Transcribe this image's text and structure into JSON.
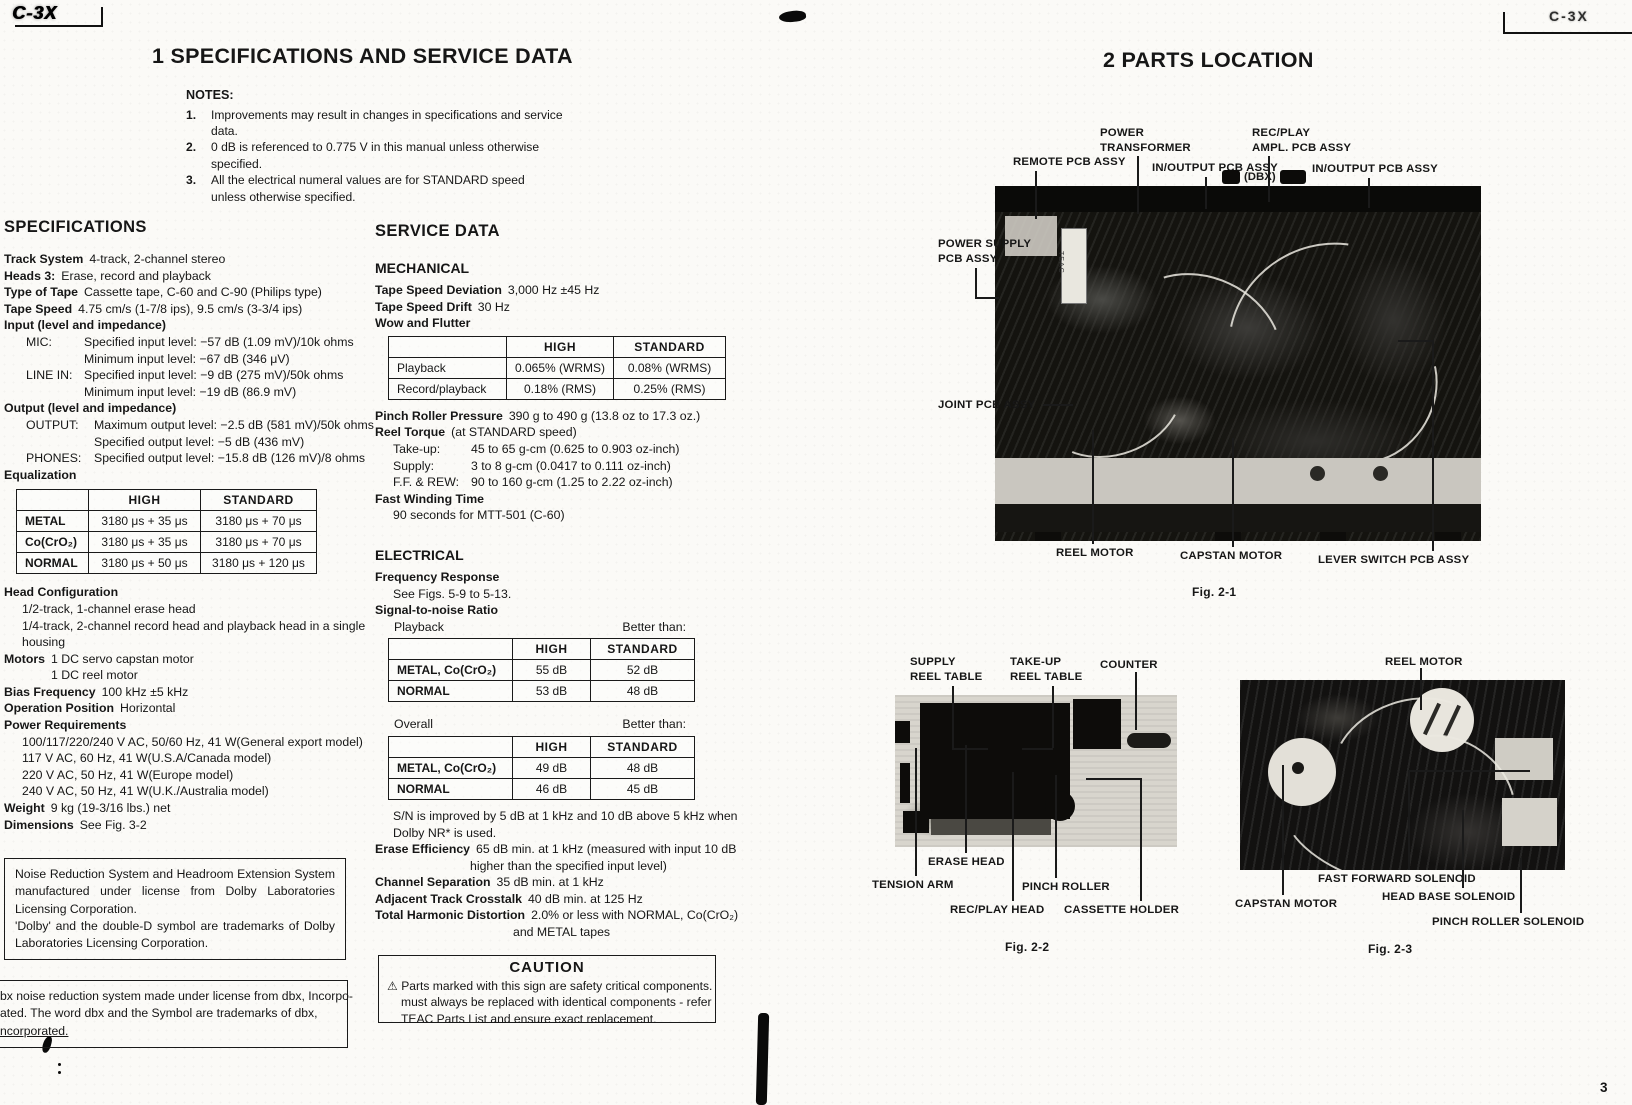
{
  "corners": {
    "left_logo": "C-3X",
    "right_logo": "C-3X",
    "page_number": "3"
  },
  "left_page": {
    "title": "1 SPECIFICATIONS AND SERVICE DATA",
    "notes": {
      "heading": "NOTES:",
      "n1": "1.",
      "n1_l1": "Improvements may result in changes in specifications and service",
      "n1_l2": "data.",
      "n2": "2.",
      "n2_l1": "0 dB is referenced to 0.775 V in this manual unless otherwise",
      "n2_l2": "specified.",
      "n3": "3.",
      "n3_l1": "All the electrical numeral values are for STANDARD speed",
      "n3_l2": "unless otherwise specified."
    },
    "specifications": {
      "heading": "SPECIFICATIONS",
      "track_system_label": "Track System",
      "track_system": "4-track, 2-channel stereo",
      "heads_label": "Heads 3:",
      "heads": "Erase, record and playback",
      "tape_type_label": "Type of Tape",
      "tape_type": "Cassette tape, C-60 and C-90 (Philips type)",
      "tape_speed_label": "Tape Speed",
      "tape_speed": "4.75 cm/s (1-7/8 ips), 9.5 cm/s (3-3/4 ips)",
      "input_heading": "Input (level and impedance)",
      "mic_label": "MIC:",
      "mic_l1": "Specified input level: −57 dB (1.09 mV)/10k ohms",
      "mic_l2": "Minimum input level: −67 dB (346 μV)",
      "line_in_label": "LINE IN:",
      "line_in_l1": "Specified input level: −9 dB (275 mV)/50k ohms",
      "line_in_l2": "Minimum input level: −19 dB (86.9 mV)",
      "output_heading": "Output (level and impedance)",
      "output_label": "OUTPUT:",
      "output_l1": "Maximum output level: −2.5 dB (581 mV)/50k ohms",
      "output_l2": "Specified output level: −5 dB (436 mV)",
      "phones_label": "PHONES:",
      "phones_l1": "Specified output level: −15.8 dB (126 mV)/8 ohms",
      "equalization_heading": "Equalization",
      "eq_table": {
        "col1": "HIGH",
        "col2": "STANDARD",
        "rows": [
          {
            "name": "METAL",
            "high": "3180 μs + 35 μs",
            "standard": "3180 μs + 70 μs"
          },
          {
            "name": "Co(CrO₂)",
            "high": "3180 μs + 35 μs",
            "standard": "3180 μs + 70 μs"
          },
          {
            "name": "NORMAL",
            "high": "3180 μs + 50 μs",
            "standard": "3180 μs + 120 μs"
          }
        ]
      },
      "head_config_heading": "Head Configuration",
      "head_config_l1": "1/2-track, 1-channel erase head",
      "head_config_l2": "1/4-track, 2-channel record head and playback head in a single",
      "head_config_l3": "housing",
      "motors_label": "Motors",
      "motors_l1": "1 DC servo capstan motor",
      "motors_l2": "1 DC reel motor",
      "bias_label": "Bias Frequency",
      "bias": "100 kHz ±5 kHz",
      "operation_label": "Operation Position",
      "operation": "Horizontal",
      "power_heading": "Power Requirements",
      "power_l1": "100/117/220/240 V AC, 50/60 Hz, 41 W(General export model)",
      "power_l2": "117 V AC, 60 Hz, 41 W(U.S.A/Canada model)",
      "power_l3": "220 V AC, 50 Hz, 41 W(Europe model)",
      "power_l4": "240 V AC, 50 Hz, 41 W(U.K./Australia model)",
      "weight_label": "Weight",
      "weight": "9 kg (19-3/16 lbs.) net",
      "dimensions_label": "Dimensions",
      "dimensions": "See Fig. 3-2"
    },
    "dolby_box": {
      "l1": "Noise Reduction System and Headroom Extension System manufactured under license from Dolby Laboratories Licensing Corporation.",
      "l2": "'Dolby' and the double-D symbol are trademarks of Dolby Laboratories Licensing Corporation."
    },
    "dbx_box": {
      "l1": "bx noise reduction system made under license from dbx, Incorpo-",
      "l2": "ated. The word dbx and the Symbol are trademarks of dbx,",
      "l3": "ncorporated."
    },
    "service_data": {
      "heading": "SERVICE DATA",
      "mechanical_heading": "MECHANICAL",
      "tsd_label": "Tape Speed Deviation",
      "tsd": "3,000 Hz ±45 Hz",
      "drift_label": "Tape Speed Drift",
      "drift": "30 Hz",
      "wow_heading": "Wow and Flutter",
      "wow_table": {
        "col1": "HIGH",
        "col2": "STANDARD",
        "rows": [
          {
            "name": "Playback",
            "high": "0.065% (WRMS)",
            "standard": "0.08% (WRMS)"
          },
          {
            "name": "Record/playback",
            "high": "0.18% (RMS)",
            "standard": "0.25% (RMS)"
          }
        ]
      },
      "pinch_label": "Pinch Roller Pressure",
      "pinch": "390 g to 490 g (13.8 oz to 17.3 oz.)",
      "reel_torque_label": "Reel Torque",
      "reel_torque": "(at STANDARD speed)",
      "takeup_label": "Take-up:",
      "takeup": "45 to 65 g-cm (0.625 to 0.903 oz-inch)",
      "supply_label": "Supply:",
      "supply": "3 to 8 g-cm (0.0417 to 0.111 oz-inch)",
      "ffrew_label": "F.F. & REW:",
      "ffrew": "90 to 160 g-cm (1.25 to 2.22 oz-inch)",
      "fast_winding_heading": "Fast Winding Time",
      "fast_winding": "90 seconds for MTT-501 (C-60)",
      "electrical_heading": "ELECTRICAL",
      "freq_heading": "Frequency Response",
      "freq": "See Figs. 5-9 to 5-13.",
      "sn_heading": "Signal-to-noise Ratio",
      "sn_playback_label": "Playback",
      "sn_better1": "Better than:",
      "sn_table1": {
        "col1": "HIGH",
        "col2": "STANDARD",
        "rows": [
          {
            "name": "METAL, Co(CrO₂)",
            "high": "55 dB",
            "standard": "52 dB"
          },
          {
            "name": "NORMAL",
            "high": "53 dB",
            "standard": "48 dB"
          }
        ]
      },
      "sn_overall_label": "Overall",
      "sn_better2": "Better than:",
      "sn_table2": {
        "col1": "HIGH",
        "col2": "STANDARD",
        "rows": [
          {
            "name": "METAL, Co(CrO₂)",
            "high": "49 dB",
            "standard": "48 dB"
          },
          {
            "name": "NORMAL",
            "high": "46 dB",
            "standard": "45 dB"
          }
        ]
      },
      "sn_note_l1": "S/N is improved by 5 dB at 1 kHz and 10 dB above 5 kHz when",
      "sn_note_l2": "Dolby NR* is used.",
      "erase_label": "Erase Efficiency",
      "erase_l1": "65 dB min. at 1 kHz (measured with input 10 dB",
      "erase_l2": "higher than the specified input level)",
      "chsep_label": "Channel Separation",
      "chsep": "35 dB min. at 1 kHz",
      "crosstalk_label": "Adjacent Track Crosstalk",
      "crosstalk": "40 dB min. at 125 Hz",
      "thd_label": "Total Harmonic Distortion",
      "thd_l1": "2.0% or less with NORMAL, Co(CrO₂)",
      "thd_l2": "and METAL tapes"
    },
    "caution_box": {
      "title": "CAUTION",
      "warning_symbol": "⚠",
      "l1": "Parts marked with this sign are safety critical components. They",
      "l2": "must always be replaced with identical components - refer to the",
      "l3": "TEAC Parts List and ensure exact replacement."
    }
  },
  "right_page": {
    "title": "2 PARTS LOCATION",
    "fig1": {
      "caption": "Fig. 2-1",
      "sticker": "TEAC",
      "labels": {
        "power_transformer": "POWER\nTRANSFORMER",
        "rec_play_ampl": "REC/PLAY\nAMPL. PCB ASSY",
        "remote_pcb": "REMOTE PCB ASSY",
        "in_output_pcb_left": "IN/OUTPUT PCB ASSY",
        "dbx": "(DBX)",
        "in_output_pcb_right": "IN/OUTPUT PCB ASSY",
        "power_supply_pcb": "POWER SUPPLY\nPCB ASSY",
        "joint_pcb": "JOINT PCB ASSY",
        "reel_motor": "REEL MOTOR",
        "capstan_motor": "CAPSTAN MOTOR",
        "lever_switch_pcb": "LEVER SWITCH PCB ASSY"
      }
    },
    "fig2": {
      "caption": "Fig. 2-2",
      "labels": {
        "supply_reel_table": "SUPPLY\nREEL TABLE",
        "take_up_reel_table": "TAKE-UP\nREEL TABLE",
        "counter": "COUNTER",
        "erase_head": "ERASE HEAD",
        "tension_arm": "TENSION ARM",
        "pinch_roller": "PINCH ROLLER",
        "rec_play_head": "REC/PLAY HEAD",
        "cassette_holder": "CASSETTE HOLDER"
      }
    },
    "fig3": {
      "caption": "Fig. 2-3",
      "labels": {
        "reel_motor": "REEL MOTOR",
        "fast_forward_solenoid": "FAST FORWARD SOLENOID",
        "capstan_motor": "CAPSTAN MOTOR",
        "head_base_solenoid": "HEAD BASE SOLENOID",
        "pinch_roller_solenoid": "PINCH ROLLER SOLENOID"
      }
    }
  }
}
